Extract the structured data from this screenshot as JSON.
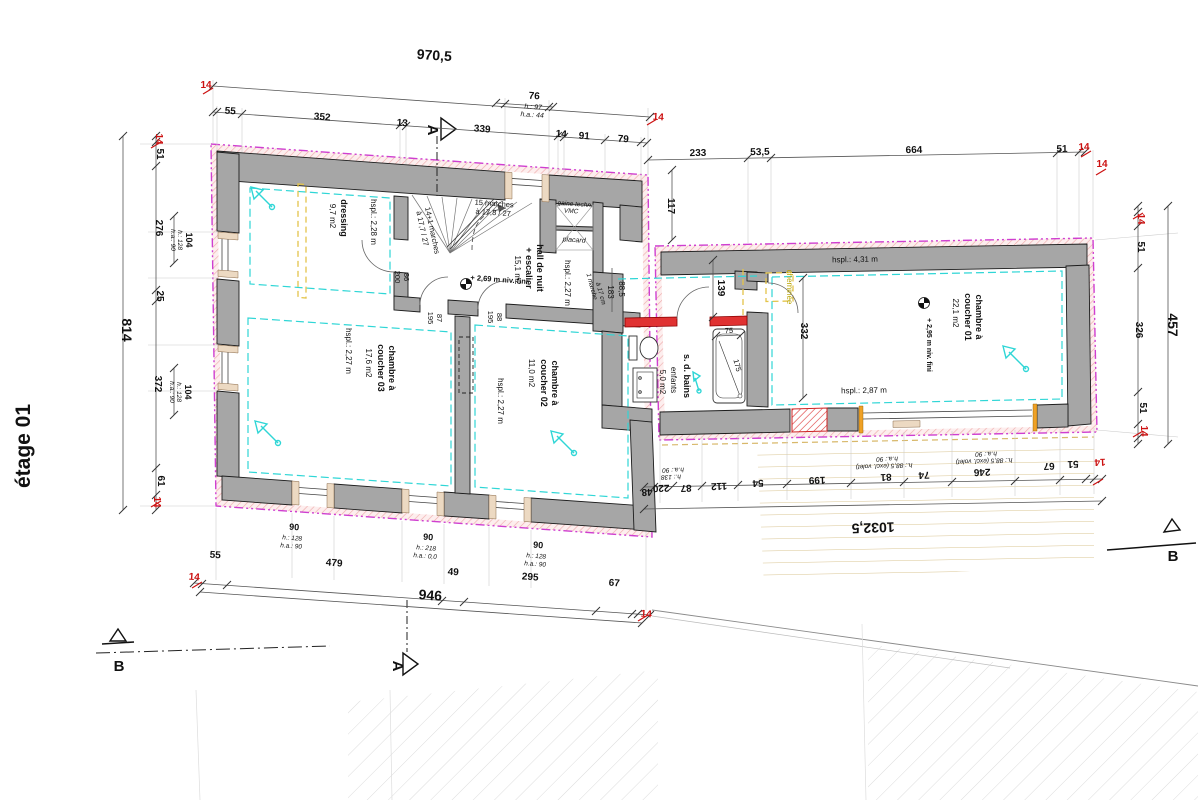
{
  "colors": {
    "wall_gray": "#a6a6a6",
    "insulation_magenta": "#cf3fd0",
    "interior_cyan": "#2fd6d6",
    "furniture_yellow": "#e3c44a",
    "new_wall_red": "#e03232",
    "dim_red": "#cc1111",
    "deck_tan": "#d9c492",
    "dim_line": "#555555"
  },
  "labels": {
    "title": [
      {
        "n": "plan-title",
        "t": "étage 01",
        "x": 30,
        "y": 446,
        "r": -90,
        "s": 21,
        "w": "bold"
      }
    ],
    "markers": [
      {
        "n": "section-marker-a-top",
        "t": "A",
        "x": 428,
        "y": 130,
        "r": 90,
        "s": 15,
        "w": "bold"
      },
      {
        "n": "section-marker-a-bottom",
        "t": "A",
        "x": 393,
        "y": 666,
        "r": 90,
        "s": 15,
        "w": "bold"
      },
      {
        "n": "section-marker-b-left",
        "t": "B",
        "x": 119,
        "y": 671,
        "s": 15,
        "w": "bold"
      },
      {
        "n": "section-marker-b-right",
        "t": "B",
        "x": 1173,
        "y": 561,
        "s": 15,
        "w": "bold"
      }
    ],
    "dims_top": [
      {
        "n": "dim-top-overall",
        "t": "970,5",
        "x": 434,
        "y": 60,
        "r": 4,
        "s": 14,
        "w": "bold"
      },
      {
        "n": "dim-ins",
        "t": "14",
        "x": 206,
        "y": 88,
        "s": 10,
        "w": "bold",
        "c": "#cc1111"
      },
      {
        "t": "55",
        "x": 230,
        "y": 114,
        "r": 4,
        "s": 10,
        "w": "bold"
      },
      {
        "t": "352",
        "x": 322,
        "y": 120,
        "r": 4,
        "s": 10,
        "w": "bold"
      },
      {
        "t": "13",
        "x": 402,
        "y": 126,
        "r": 4,
        "s": 10,
        "w": "bold"
      },
      {
        "t": "339",
        "x": 482,
        "y": 132,
        "r": 4,
        "s": 10,
        "w": "bold"
      },
      {
        "t": "14",
        "x": 561,
        "y": 137,
        "r": 4,
        "s": 10,
        "w": "bold"
      },
      {
        "t": "91",
        "x": 584,
        "y": 139,
        "r": 4,
        "s": 10,
        "w": "bold"
      },
      {
        "t": "79",
        "x": 623,
        "y": 142,
        "r": 4,
        "s": 10,
        "w": "bold"
      },
      {
        "n": "dim-ins",
        "t": "14",
        "x": 658,
        "y": 120,
        "r": 4,
        "s": 10,
        "w": "bold",
        "c": "#cc1111"
      },
      {
        "t": "76",
        "x": 534,
        "y": 99,
        "r": 4,
        "s": 10,
        "w": "bold"
      },
      {
        "t": "h.: 97",
        "x": 533,
        "y": 109,
        "r": 4,
        "s": 7,
        "i": 1
      },
      {
        "t": "h.a.: 44",
        "x": 532,
        "y": 117,
        "r": 4,
        "s": 7,
        "i": 1
      },
      {
        "t": "233",
        "x": 698,
        "y": 156,
        "r": -1,
        "s": 10,
        "w": "bold"
      },
      {
        "t": "53,5",
        "x": 760,
        "y": 155,
        "r": -1,
        "s": 10,
        "w": "bold"
      },
      {
        "t": "664",
        "x": 914,
        "y": 153,
        "r": -1,
        "s": 10,
        "w": "bold"
      },
      {
        "t": "51",
        "x": 1062,
        "y": 152,
        "r": -1,
        "s": 10,
        "w": "bold"
      },
      {
        "n": "dim-ins",
        "t": "14",
        "x": 1084,
        "y": 150,
        "r": -1,
        "s": 10,
        "w": "bold",
        "c": "#cc1111"
      },
      {
        "t": "117",
        "x": 668,
        "y": 206,
        "r": 90,
        "s": 10,
        "w": "bold"
      },
      {
        "n": "dim-ins",
        "t": "14",
        "x": 1102,
        "y": 167,
        "s": 10,
        "w": "bold",
        "c": "#cc1111"
      }
    ],
    "dims_left": [
      {
        "n": "dim-ins",
        "t": "14",
        "x": 156,
        "y": 139,
        "r": 90,
        "s": 10,
        "w": "bold",
        "c": "#cc1111"
      },
      {
        "t": "51",
        "x": 157,
        "y": 154,
        "r": 90,
        "s": 10,
        "w": "bold"
      },
      {
        "t": "276",
        "x": 156,
        "y": 228,
        "r": 90,
        "s": 10,
        "w": "bold"
      },
      {
        "t": "104",
        "x": 186,
        "y": 240,
        "r": 90,
        "s": 9,
        "w": "bold"
      },
      {
        "t": "h.: 128",
        "x": 178,
        "y": 240,
        "r": 90,
        "s": 6.5,
        "i": 1
      },
      {
        "t": "h.a.: 90",
        "x": 171,
        "y": 240,
        "r": 90,
        "s": 6.5,
        "i": 1
      },
      {
        "t": "25",
        "x": 157,
        "y": 296,
        "r": 90,
        "s": 10,
        "w": "bold"
      },
      {
        "t": "372",
        "x": 155,
        "y": 384,
        "r": 90,
        "s": 10,
        "w": "bold"
      },
      {
        "t": "104",
        "x": 185,
        "y": 392,
        "r": 90,
        "s": 9,
        "w": "bold"
      },
      {
        "t": "h.: 128",
        "x": 177,
        "y": 392,
        "r": 90,
        "s": 6.5,
        "i": 1
      },
      {
        "t": "h.a.: 90",
        "x": 170,
        "y": 392,
        "r": 90,
        "s": 6.5,
        "i": 1
      },
      {
        "t": "61",
        "x": 158,
        "y": 481,
        "r": 90,
        "s": 10,
        "w": "bold"
      },
      {
        "n": "dim-ins",
        "t": "14",
        "x": 154,
        "y": 502,
        "r": 90,
        "s": 10,
        "w": "bold",
        "c": "#cc1111"
      },
      {
        "n": "dim-left-overall",
        "t": "814",
        "x": 122,
        "y": 330,
        "r": 90,
        "s": 14,
        "w": "bold"
      }
    ],
    "dims_right": [
      {
        "n": "dim-ins",
        "t": "14",
        "x": 1138,
        "y": 219,
        "r": 90,
        "s": 10,
        "w": "bold",
        "c": "#cc1111"
      },
      {
        "t": "51",
        "x": 1138,
        "y": 247,
        "r": 90,
        "s": 10,
        "w": "bold"
      },
      {
        "t": "326",
        "x": 1136,
        "y": 330,
        "r": 90,
        "s": 10,
        "w": "bold"
      },
      {
        "t": "51",
        "x": 1140,
        "y": 408,
        "r": 90,
        "s": 10,
        "w": "bold"
      },
      {
        "n": "dim-ins",
        "t": "14",
        "x": 1141,
        "y": 431,
        "r": 90,
        "s": 10,
        "w": "bold",
        "c": "#cc1111"
      },
      {
        "n": "dim-right-overall",
        "t": "457",
        "x": 1168,
        "y": 325,
        "r": 90,
        "s": 14,
        "w": "bold"
      }
    ],
    "dims_bottom": [
      {
        "n": "dim-ins",
        "t": "14",
        "x": 194,
        "y": 580,
        "r": 4,
        "s": 10,
        "w": "bold",
        "c": "#cc1111"
      },
      {
        "t": "55",
        "x": 215,
        "y": 558,
        "r": 4,
        "s": 10,
        "w": "bold"
      },
      {
        "t": "479",
        "x": 334,
        "y": 566,
        "r": 4,
        "s": 10,
        "w": "bold"
      },
      {
        "t": "49",
        "x": 453,
        "y": 575,
        "r": 4,
        "s": 10,
        "w": "bold"
      },
      {
        "t": "295",
        "x": 530,
        "y": 580,
        "r": 4,
        "s": 10,
        "w": "bold"
      },
      {
        "t": "67",
        "x": 614,
        "y": 586,
        "r": 4,
        "s": 10,
        "w": "bold"
      },
      {
        "n": "dim-ins",
        "t": "14",
        "x": 646,
        "y": 617,
        "r": 4,
        "s": 10,
        "w": "bold",
        "c": "#cc1111"
      },
      {
        "n": "dim-bottom-overall",
        "t": "946",
        "x": 430,
        "y": 600,
        "r": 4,
        "s": 14,
        "w": "bold"
      },
      {
        "t": "90",
        "x": 294,
        "y": 530,
        "r": 4,
        "s": 9,
        "w": "bold"
      },
      {
        "t": "h.: 128",
        "x": 292,
        "y": 540,
        "r": 4,
        "s": 6.5,
        "i": 1
      },
      {
        "t": "h.a.: 90",
        "x": 291,
        "y": 548,
        "r": 4,
        "s": 6.5,
        "i": 1
      },
      {
        "t": "90",
        "x": 428,
        "y": 540,
        "r": 4,
        "s": 9,
        "w": "bold"
      },
      {
        "t": "h.: 218",
        "x": 426,
        "y": 550,
        "r": 4,
        "s": 6.5,
        "i": 1
      },
      {
        "t": "h.a.: 0,0",
        "x": 425,
        "y": 558,
        "r": 4,
        "s": 6.5,
        "i": 1
      },
      {
        "t": "90",
        "x": 538,
        "y": 548,
        "r": 4,
        "s": 9,
        "w": "bold"
      },
      {
        "t": "h.: 128",
        "x": 536,
        "y": 558,
        "r": 4,
        "s": 6.5,
        "i": 1
      },
      {
        "t": "h.a.: 90",
        "x": 535,
        "y": 566,
        "r": 4,
        "s": 6.5,
        "i": 1
      }
    ],
    "dims_wing": [
      {
        "t": "48",
        "x": 647,
        "y": 489,
        "r": 178,
        "s": 10,
        "w": "bold"
      },
      {
        "t": "220",
        "x": 661,
        "y": 485,
        "r": 178,
        "s": 10,
        "w": "bold"
      },
      {
        "t": "h.: 138",
        "x": 671,
        "y": 475,
        "r": 178,
        "s": 6.5,
        "i": 1
      },
      {
        "t": "h.a.: 90",
        "x": 673,
        "y": 468,
        "r": 178,
        "s": 6.5,
        "i": 1
      },
      {
        "t": "87",
        "x": 686,
        "y": 485,
        "r": 178,
        "s": 10,
        "w": "bold"
      },
      {
        "t": "112",
        "x": 719,
        "y": 483,
        "r": 178,
        "s": 10,
        "w": "bold"
      },
      {
        "t": "54",
        "x": 758,
        "y": 480,
        "r": 178,
        "s": 10,
        "w": "bold"
      },
      {
        "t": "199",
        "x": 817,
        "y": 477,
        "r": 178,
        "s": 10,
        "w": "bold"
      },
      {
        "t": "81",
        "x": 886,
        "y": 474,
        "r": 178,
        "s": 10,
        "w": "bold"
      },
      {
        "t": "h.: 88,5 (excl. volet)",
        "x": 884,
        "y": 464,
        "r": 178,
        "s": 6.5,
        "i": 1
      },
      {
        "t": "h.a.: 90",
        "x": 887,
        "y": 457,
        "r": 178,
        "s": 6.5,
        "i": 1
      },
      {
        "t": "74",
        "x": 924,
        "y": 472,
        "r": 178,
        "s": 10,
        "w": "bold"
      },
      {
        "t": "246",
        "x": 982,
        "y": 469,
        "r": 178,
        "s": 10,
        "w": "bold"
      },
      {
        "t": "h.: 88,5 (excl. volet)",
        "x": 984,
        "y": 459,
        "r": 178,
        "s": 6.5,
        "i": 1
      },
      {
        "t": "h.a.: 90",
        "x": 986,
        "y": 452,
        "r": 178,
        "s": 6.5,
        "i": 1
      },
      {
        "t": "67",
        "x": 1049,
        "y": 463,
        "r": 178,
        "s": 10,
        "w": "bold"
      },
      {
        "t": "51",
        "x": 1073,
        "y": 461,
        "r": 178,
        "s": 10,
        "w": "bold"
      },
      {
        "n": "dim-ins",
        "t": "14",
        "x": 1100,
        "y": 459,
        "r": 178,
        "s": 10,
        "w": "bold",
        "c": "#cc1111"
      },
      {
        "n": "dim-wing-overall",
        "t": "1032,5",
        "x": 873,
        "y": 523,
        "r": 178,
        "s": 14,
        "w": "bold"
      },
      {
        "t": "139",
        "x": 718,
        "y": 288,
        "r": 90,
        "s": 10,
        "w": "bold"
      },
      {
        "t": "332",
        "x": 801,
        "y": 331,
        "r": 90,
        "s": 10,
        "w": "bold"
      },
      {
        "t": "88,5",
        "x": 619,
        "y": 289,
        "r": 90,
        "s": 8
      },
      {
        "t": "183",
        "x": 608,
        "y": 292,
        "r": 90,
        "s": 8
      },
      {
        "t": "75",
        "x": 729,
        "y": 333,
        "r": -1,
        "s": 7.5
      },
      {
        "t": "175",
        "x": 735,
        "y": 366,
        "r": 75,
        "s": 7.5
      }
    ],
    "rooms": [
      {
        "n": "room-dressing",
        "t": "dressing",
        "x": 341,
        "y": 218,
        "r": 90,
        "s": 9,
        "w": "bold"
      },
      {
        "n": "room-dressing-area",
        "t": "9,7 m2",
        "x": 330,
        "y": 216,
        "r": 90,
        "s": 8
      },
      {
        "n": "room-dressing-hspl",
        "t": "hspl.: 2,28 m",
        "x": 371,
        "y": 222,
        "r": 90,
        "s": 8
      },
      {
        "n": "room-hall",
        "t": "hall de nuit",
        "x": 537,
        "y": 268,
        "r": 90,
        "s": 9,
        "w": "bold"
      },
      {
        "n": "room-hall",
        "t": "+ escalier",
        "x": 526,
        "y": 268,
        "r": 90,
        "s": 9,
        "w": "bold"
      },
      {
        "n": "room-hall-area",
        "t": "15,1 m2",
        "x": 515,
        "y": 270,
        "r": 90,
        "s": 8
      },
      {
        "n": "room-hall-hspl",
        "t": "hspl.: 2,27 m",
        "x": 565,
        "y": 283,
        "r": 90,
        "s": 8
      },
      {
        "n": "room-ch03",
        "t": "chambre à",
        "x": 389,
        "y": 368,
        "r": 90,
        "s": 9,
        "w": "bold"
      },
      {
        "n": "room-ch03",
        "t": "coucher 03",
        "x": 378,
        "y": 368,
        "r": 90,
        "s": 9,
        "w": "bold"
      },
      {
        "n": "room-ch03-area",
        "t": "17,6 m2",
        "x": 366,
        "y": 363,
        "r": 90,
        "s": 8
      },
      {
        "n": "room-ch03-hspl",
        "t": "hspl.: 2,27 m",
        "x": 346,
        "y": 351,
        "r": 90,
        "s": 8
      },
      {
        "n": "room-ch02",
        "t": "chambre à",
        "x": 552,
        "y": 383,
        "r": 90,
        "s": 9,
        "w": "bold"
      },
      {
        "n": "room-ch02",
        "t": "coucher 02",
        "x": 541,
        "y": 383,
        "r": 90,
        "s": 9,
        "w": "bold"
      },
      {
        "n": "room-ch02-area",
        "t": "11,0 m2",
        "x": 529,
        "y": 373,
        "r": 90,
        "s": 8
      },
      {
        "n": "room-ch02-hspl",
        "t": "hspl.: 2,27 m",
        "x": 498,
        "y": 401,
        "r": 90,
        "s": 8
      },
      {
        "n": "room-sdb",
        "t": "s. d. bains",
        "x": 684,
        "y": 376,
        "r": 90,
        "s": 9,
        "w": "bold"
      },
      {
        "n": "room-sdb",
        "t": "enfants",
        "x": 671,
        "y": 380,
        "r": 90,
        "s": 8
      },
      {
        "n": "room-sdb-area",
        "t": "5,0 m2",
        "x": 660,
        "y": 382,
        "r": 90,
        "s": 8
      },
      {
        "n": "room-ch01",
        "t": "chambre à",
        "x": 976,
        "y": 317,
        "r": 90,
        "s": 9,
        "w": "bold"
      },
      {
        "n": "room-ch01",
        "t": "coucher 01",
        "x": 965,
        "y": 317,
        "r": 90,
        "s": 9,
        "w": "bold"
      },
      {
        "n": "room-ch01-area",
        "t": "22,1 m2",
        "x": 953,
        "y": 313,
        "r": 90,
        "s": 8
      },
      {
        "n": "room-ch01-hspl",
        "t": "hspl.: 4,31 m",
        "x": 855,
        "y": 262,
        "r": -1,
        "s": 8
      },
      {
        "n": "room-ch01-hspl2",
        "t": "hspl.: 2,87 m",
        "x": 864,
        "y": 393,
        "r": -1,
        "s": 8
      },
      {
        "n": "room-ch01-level",
        "t": "+ 2,95 m niv. fini",
        "x": 927,
        "y": 345,
        "r": 90,
        "s": 7,
        "w": "bold"
      }
    ],
    "annotations": [
      {
        "n": "stair-note",
        "t": "15 marches",
        "x": 494,
        "y": 206,
        "r": 4,
        "s": 7.5
      },
      {
        "n": "stair-note",
        "t": "à 17,8 / 27",
        "x": 493,
        "y": 215,
        "r": 4,
        "s": 7.5
      },
      {
        "n": "stair-note",
        "t": "14+1 marches",
        "x": 430,
        "y": 231,
        "r": 78,
        "s": 7.5
      },
      {
        "n": "stair-note",
        "t": "à 17,7 / 27",
        "x": 420,
        "y": 229,
        "r": 78,
        "s": 7.5
      },
      {
        "n": "level-note",
        "t": "+ 2,69 m niv. fini",
        "x": 499,
        "y": 282,
        "r": 4,
        "s": 7.5,
        "w": "bold"
      },
      {
        "n": "duct-label",
        "t": "gaine techn.",
        "x": 575,
        "y": 206,
        "r": 4,
        "s": 6.5,
        "i": 1
      },
      {
        "n": "duct-label",
        "t": "VMC",
        "x": 571,
        "y": 213,
        "r": 4,
        "s": 6.5,
        "i": 1
      },
      {
        "n": "closet-label",
        "t": "placard",
        "x": 574,
        "y": 242,
        "r": 4,
        "s": 7,
        "i": 1
      },
      {
        "n": "step-note",
        "t": "1 marche",
        "x": 590,
        "y": 287,
        "r": 75,
        "s": 6.5,
        "i": 1
      },
      {
        "n": "step-note",
        "t": "à 17 cm",
        "x": 599,
        "y": 294,
        "r": 75,
        "s": 6.5,
        "i": 1
      },
      {
        "n": "chimney-label",
        "t": "cheminée",
        "x": 787,
        "y": 287,
        "r": 90,
        "s": 8,
        "c": "#b9a400"
      },
      {
        "n": "door-width",
        "t": "86",
        "x": 404,
        "y": 277,
        "r": 90,
        "s": 7.5
      },
      {
        "n": "door-height",
        "t": "200",
        "x": 395,
        "y": 277,
        "r": 90,
        "s": 7.5
      },
      {
        "n": "door-width",
        "t": "87",
        "x": 437,
        "y": 318,
        "r": 90,
        "s": 7.5
      },
      {
        "n": "door-height",
        "t": "195",
        "x": 428,
        "y": 318,
        "r": 90,
        "s": 7.5
      },
      {
        "n": "door-width",
        "t": "88",
        "x": 497,
        "y": 317,
        "r": 90,
        "s": 7.5
      },
      {
        "n": "door-height",
        "t": "195",
        "x": 488,
        "y": 317,
        "r": 90,
        "s": 7.5
      }
    ]
  }
}
